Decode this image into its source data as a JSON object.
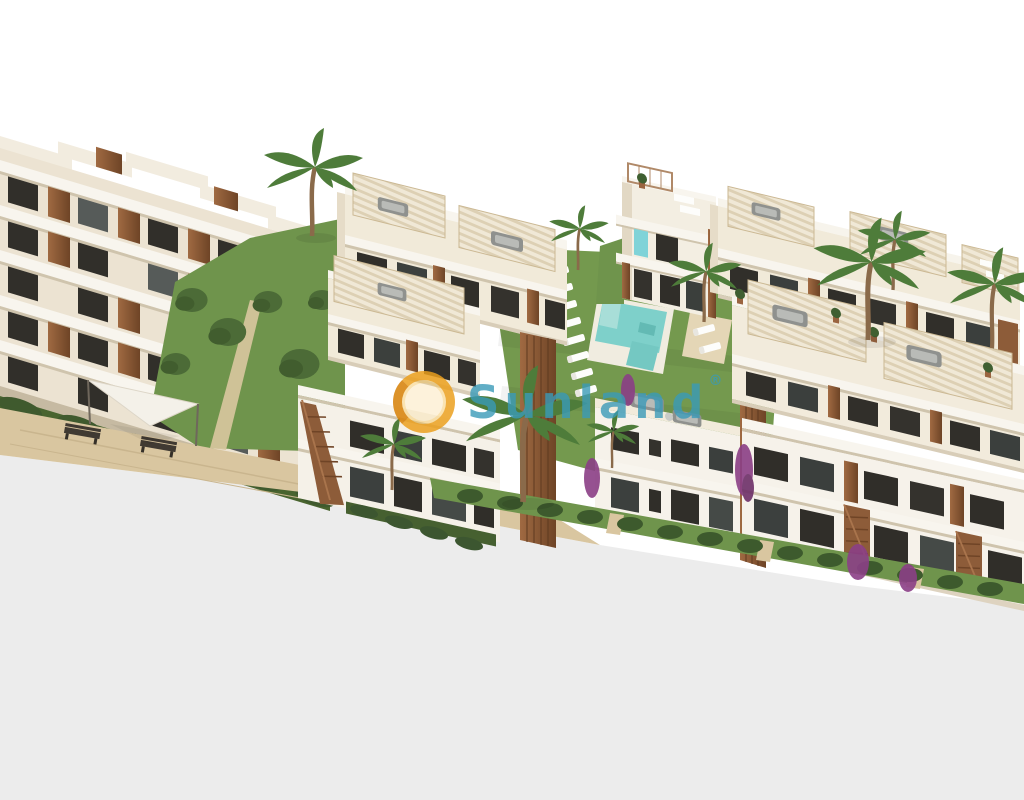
{
  "watermark": {
    "brand": "Sunland",
    "registered": "®",
    "brand_color": "#3a9ab8",
    "logo_ring_color": "#eb9e1a"
  },
  "palette": {
    "background": "#ffffff",
    "ground_plane": "#ececec",
    "wall_cream": "#f1ead9",
    "wall_white": "#f6f2ea",
    "slab_white": "#f8f5ee",
    "window_dark": "#312f2a",
    "wood": "#8d5c39",
    "lawn_green": "#74994e",
    "hedge_green": "#3f5a2e",
    "pool_water": "#7ed0ca",
    "sand_path": "#d9c6a0",
    "canopy_stripe": "#f0e8d6",
    "bougainvillea": "#8b3f86"
  },
  "scene": {
    "elements": [
      "terraced-apartment-block",
      "pergola-roof-terraces",
      "communal-swimming-pool",
      "sun-loungers",
      "palm-trees",
      "lawns-and-hedges",
      "wooden-stairs",
      "park-benches",
      "shade-sail",
      "bougainvillea"
    ]
  }
}
